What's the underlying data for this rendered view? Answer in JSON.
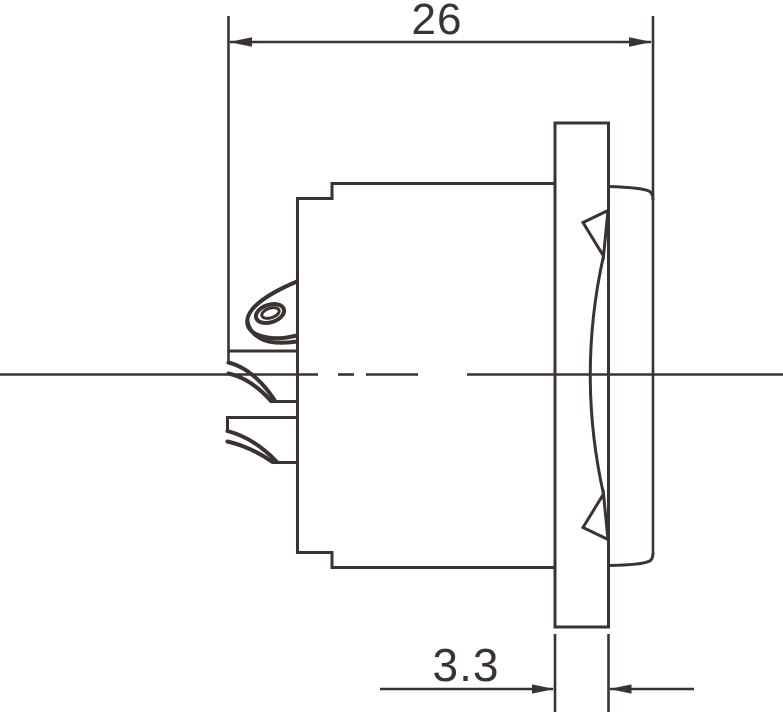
{
  "drawing": {
    "line_color": "#3a3331",
    "background_color": "#ffffff",
    "dimensions": [
      {
        "id": "overall-depth",
        "label": "26"
      },
      {
        "id": "panel-thickness",
        "label": "3.3"
      }
    ]
  }
}
